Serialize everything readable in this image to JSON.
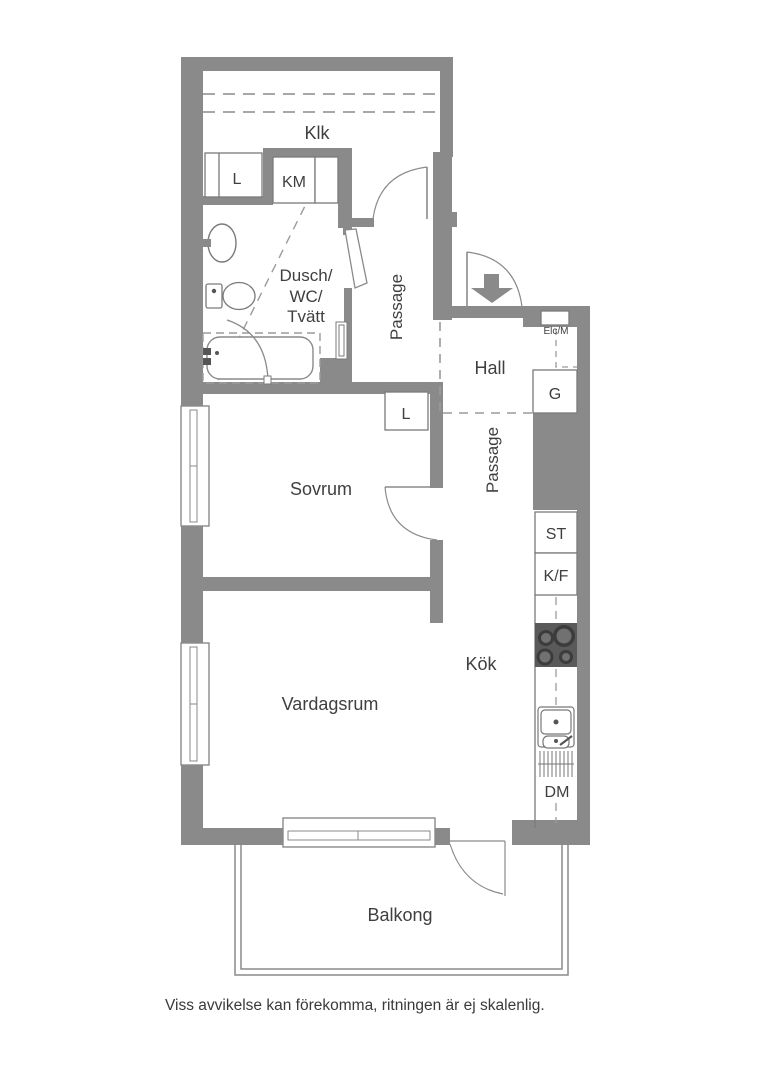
{
  "floorplan": {
    "rooms": {
      "klk": "Klk",
      "bathroom_line1": "Dusch/",
      "bathroom_line2": "WC/",
      "bathroom_line3": "Tvätt",
      "passage_upper": "Passage",
      "hall": "Hall",
      "passage_lower": "Passage",
      "sovrum": "Sovrum",
      "kok": "Kök",
      "vardagsrum": "Vardagsrum",
      "balkong": "Balkong"
    },
    "fixtures": {
      "closet_bathroom_row": "L",
      "washing_machine": "KM",
      "closet_sovrum": "L",
      "wardrobe_hall": "G",
      "cleaning_closet": "ST",
      "fridge_freezer": "K/F",
      "dishwasher": "DM",
      "electrical_meter": "Elc/M"
    },
    "footer": {
      "disclaimer": "Viss avvikelse kan förekomma, ritningen är ej skalenlig."
    },
    "colors": {
      "wall": "#8a8a8a",
      "text": "#3f3f3f",
      "stove": "#5a5a5a",
      "burner_ring": "#3c3c3c",
      "burner_center": "#717171",
      "fixture_stroke": "#7a7a7a",
      "dashed": "#9b9b9b",
      "background": "#ffffff"
    }
  }
}
